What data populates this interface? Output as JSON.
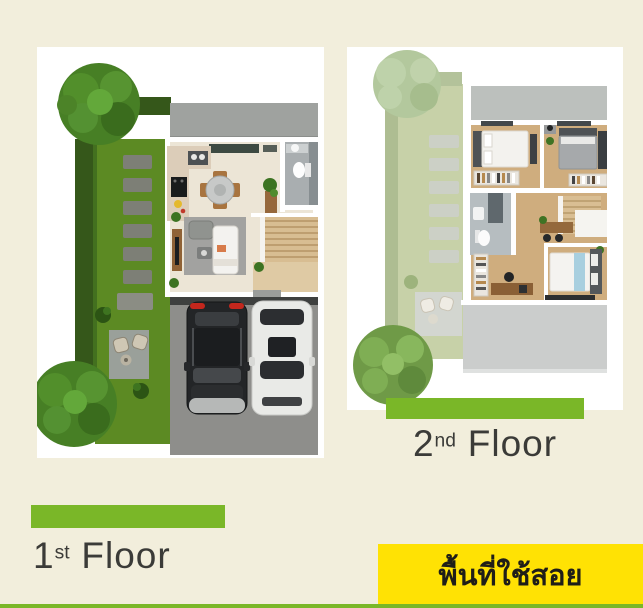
{
  "colors": {
    "background": "#f2eedc",
    "card_background": "#ffffff",
    "accent_green": "#7ab728",
    "badge_yellow": "#ffe204",
    "label_text": "#3b3b38",
    "badge_text": "#1f1e18"
  },
  "floor1_label": {
    "number": "1",
    "suffix": "st",
    "word": "Floor"
  },
  "floor2_label": {
    "number": "2",
    "suffix": "nd",
    "word": "Floor"
  },
  "badge": {
    "text": "พื้นที่ใช้สอย"
  }
}
